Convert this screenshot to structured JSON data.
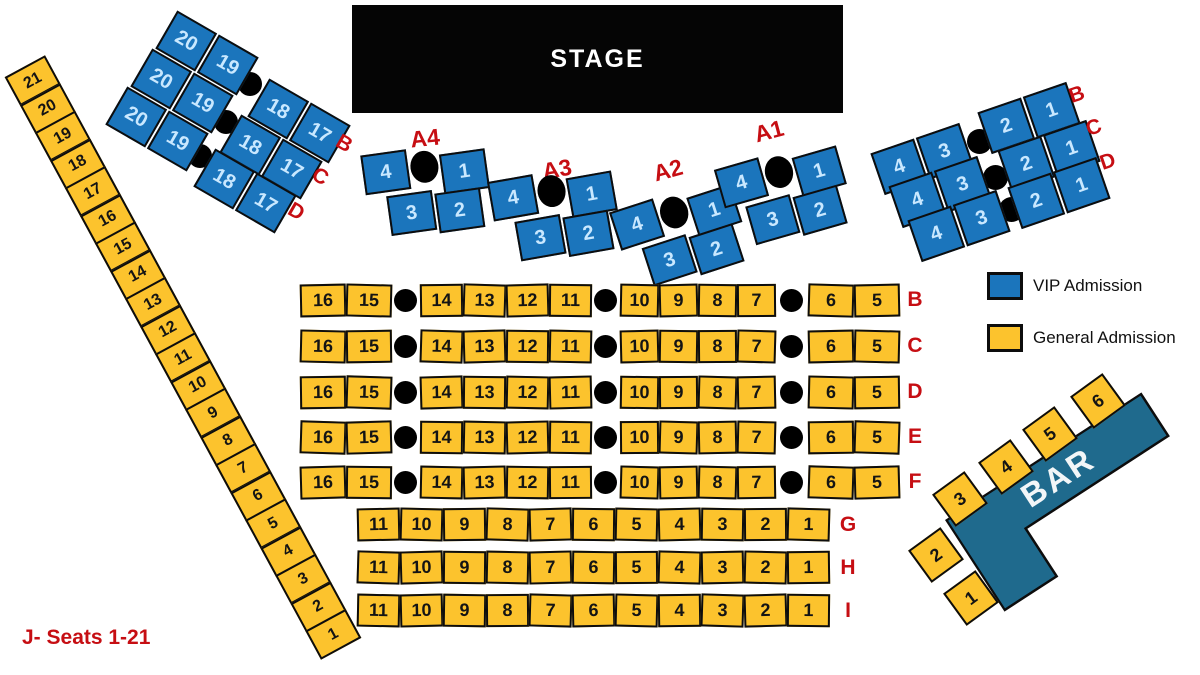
{
  "colors": {
    "vip_blue": "#1B75BC",
    "ga_yellow": "#FCC32D",
    "bar_teal": "#1F6A8D",
    "red": "#C60E13",
    "vip_seat_text": "#C9E8FF",
    "stage_black": "#050505"
  },
  "stage": {
    "label": "STAGE"
  },
  "legend": {
    "items": [
      {
        "label": "VIP Admission",
        "swatch": "vip"
      },
      {
        "label": "General Admission",
        "swatch": "ga"
      }
    ]
  },
  "vip_left_rows": [
    {
      "letter": "B",
      "pair_left": [
        "20",
        "19"
      ],
      "pair_right": [
        "18",
        "17"
      ]
    },
    {
      "letter": "C",
      "pair_left": [
        "20",
        "19"
      ],
      "pair_right": [
        "18",
        "17"
      ]
    },
    {
      "letter": "D",
      "pair_left": [
        "20",
        "19"
      ],
      "pair_right": [
        "18",
        "17"
      ]
    }
  ],
  "vip_right_rows": [
    {
      "letter": "B",
      "pair_left": [
        "4",
        "3"
      ],
      "pair_right": [
        "2",
        "1"
      ]
    },
    {
      "letter": "C",
      "pair_left": [
        "4",
        "3"
      ],
      "pair_right": [
        "2",
        "1"
      ]
    },
    {
      "letter": "D",
      "pair_left": [
        "4",
        "3"
      ],
      "pair_right": [
        "2",
        "1"
      ]
    }
  ],
  "vip_tables": [
    {
      "label": "A4",
      "top_left_seat": "4",
      "top_right_seat": "1",
      "bottom_seats": [
        "3",
        "2"
      ]
    },
    {
      "label": "A3",
      "top_left_seat": "4",
      "top_right_seat": "1",
      "bottom_seats": [
        "3",
        "2"
      ]
    },
    {
      "label": "A2",
      "top_left_seat": "4",
      "top_right_seat": "1",
      "bottom_seats": [
        "3",
        "2"
      ]
    },
    {
      "label": "A1",
      "top_left_seat": "4",
      "top_right_seat": "1",
      "bottom_seats": [
        "3",
        "2"
      ]
    }
  ],
  "ga_rows_main": [
    {
      "letter": "B",
      "groups": [
        [
          "16",
          "15"
        ],
        [
          "14",
          "13",
          "12",
          "11"
        ],
        [
          "10",
          "9",
          "8",
          "7"
        ],
        [
          "6",
          "5"
        ]
      ]
    },
    {
      "letter": "C",
      "groups": [
        [
          "16",
          "15"
        ],
        [
          "14",
          "13",
          "12",
          "11"
        ],
        [
          "10",
          "9",
          "8",
          "7"
        ],
        [
          "6",
          "5"
        ]
      ]
    },
    {
      "letter": "D",
      "groups": [
        [
          "16",
          "15"
        ],
        [
          "14",
          "13",
          "12",
          "11"
        ],
        [
          "10",
          "9",
          "8",
          "7"
        ],
        [
          "6",
          "5"
        ]
      ]
    },
    {
      "letter": "E",
      "groups": [
        [
          "16",
          "15"
        ],
        [
          "14",
          "13",
          "12",
          "11"
        ],
        [
          "10",
          "9",
          "8",
          "7"
        ],
        [
          "6",
          "5"
        ]
      ]
    },
    {
      "letter": "F",
      "groups": [
        [
          "16",
          "15"
        ],
        [
          "14",
          "13",
          "12",
          "11"
        ],
        [
          "10",
          "9",
          "8",
          "7"
        ],
        [
          "6",
          "5"
        ]
      ]
    }
  ],
  "ga_rows_front": [
    {
      "letter": "G",
      "seats": [
        "11",
        "10",
        "9",
        "8",
        "7",
        "6",
        "5",
        "4",
        "3",
        "2",
        "1"
      ]
    },
    {
      "letter": "H",
      "seats": [
        "11",
        "10",
        "9",
        "8",
        "7",
        "6",
        "5",
        "4",
        "3",
        "2",
        "1"
      ]
    },
    {
      "letter": "I",
      "seats": [
        "11",
        "10",
        "9",
        "8",
        "7",
        "6",
        "5",
        "4",
        "3",
        "2",
        "1"
      ]
    }
  ],
  "j_row": {
    "label": "J- Seats 1-21",
    "seats": [
      "21",
      "20",
      "19",
      "18",
      "17",
      "16",
      "15",
      "14",
      "13",
      "12",
      "11",
      "10",
      "9",
      "8",
      "7",
      "6",
      "5",
      "4",
      "3",
      "2",
      "1"
    ]
  },
  "bar": {
    "label": "BAR",
    "upper_seats": [
      "3",
      "4",
      "5",
      "6"
    ],
    "lower_seats": [
      "2",
      "1"
    ]
  }
}
